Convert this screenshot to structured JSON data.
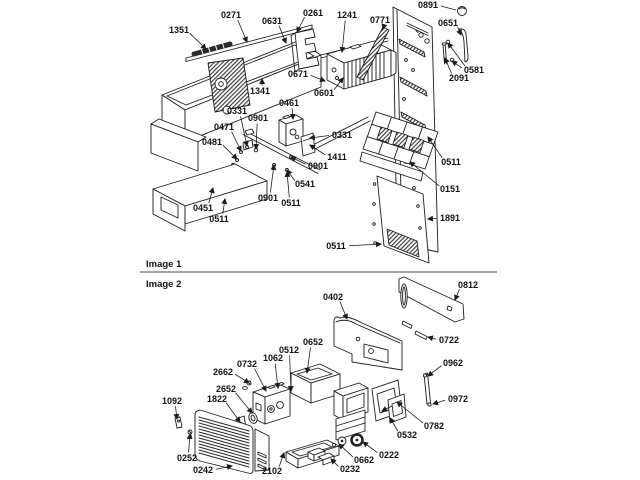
{
  "page": {
    "background": "#ffffff",
    "line_color": "#1c1c1c",
    "label_color": "#111111",
    "type": "exploded-parts-diagram"
  },
  "image1": {
    "title": "Image 1",
    "labels": [
      {
        "text": "0271",
        "x": 231,
        "y": 15,
        "tx": 247,
        "ty": 42
      },
      {
        "text": "0631",
        "x": 272,
        "y": 21,
        "tx": 286,
        "ty": 43
      },
      {
        "text": "1351",
        "x": 179,
        "y": 30,
        "tx": 206,
        "ty": 49
      },
      {
        "text": "0261",
        "x": 313,
        "y": 13,
        "tx": 297,
        "ty": 32
      },
      {
        "text": "1241",
        "x": 347,
        "y": 15,
        "tx": 342,
        "ty": 52
      },
      {
        "text": "0771",
        "x": 380,
        "y": 20,
        "tx": 383,
        "ty": 29
      },
      {
        "text": "0891",
        "x": 428,
        "y": 5,
        "tx": 456,
        "ty": 10,
        "na": 1
      },
      {
        "text": "0651",
        "x": 448,
        "y": 23,
        "tx": 461,
        "ty": 35
      },
      {
        "text": "0581",
        "x": 474,
        "y": 70,
        "tx": 448,
        "ty": 43,
        "tx2": 452,
        "ty2": 61
      },
      {
        "text": "2091",
        "x": 459,
        "y": 78,
        "tx": 445,
        "ty": 58
      },
      {
        "text": "0671",
        "x": 298,
        "y": 74,
        "tx": 325,
        "ty": 81
      },
      {
        "text": "0601",
        "x": 324,
        "y": 93,
        "tx": 343,
        "ty": 78
      },
      {
        "text": "1341",
        "x": 260,
        "y": 91,
        "tx": 262,
        "ty": 79
      },
      {
        "text": "0461",
        "x": 289,
        "y": 103,
        "tx": 293,
        "ty": 119
      },
      {
        "text": "0331",
        "x": 237,
        "y": 111,
        "tx": 247,
        "ty": 146
      },
      {
        "text": "0901",
        "x": 258,
        "y": 118,
        "tx": 256,
        "ty": 149
      },
      {
        "text": "0471",
        "x": 224,
        "y": 127,
        "tx": 241,
        "ty": 151
      },
      {
        "text": "0481",
        "x": 212,
        "y": 142,
        "tx": 237,
        "ty": 159
      },
      {
        "text": "0331",
        "x": 342,
        "y": 135,
        "tx": 310,
        "ty": 138
      },
      {
        "text": "1411",
        "x": 337,
        "y": 157,
        "tx": 310,
        "ty": 145
      },
      {
        "text": "0901",
        "x": 318,
        "y": 166,
        "tx": 291,
        "ty": 157
      },
      {
        "text": "0541",
        "x": 305,
        "y": 184,
        "tx": 287,
        "ty": 170
      },
      {
        "text": "0901",
        "x": 268,
        "y": 198,
        "tx": 274,
        "ty": 165
      },
      {
        "text": "0511",
        "x": 291,
        "y": 203,
        "tx": 287,
        "ty": 172
      },
      {
        "text": "0451",
        "x": 203,
        "y": 208,
        "tx": 213,
        "ty": 188
      },
      {
        "text": "0511",
        "x": 219,
        "y": 219,
        "tx": 225,
        "ty": 199
      },
      {
        "text": "0511",
        "x": 451,
        "y": 162,
        "tx": 428,
        "ty": 137
      },
      {
        "text": "0151",
        "x": 450,
        "y": 189,
        "tx": 410,
        "ty": 162
      },
      {
        "text": "1891",
        "x": 450,
        "y": 218,
        "tx": 428,
        "ty": 219
      },
      {
        "text": "0511",
        "x": 336,
        "y": 246,
        "tx": 381,
        "ty": 244
      }
    ]
  },
  "image2": {
    "title": "Image 2",
    "labels": [
      {
        "text": "0402",
        "x": 333,
        "y": 297,
        "tx": 347,
        "ty": 319
      },
      {
        "text": "0812",
        "x": 468,
        "y": 285,
        "tx": 455,
        "ty": 300
      },
      {
        "text": "0722",
        "x": 449,
        "y": 340,
        "tx": 428,
        "ty": 337
      },
      {
        "text": "0962",
        "x": 453,
        "y": 363,
        "tx": 428,
        "ty": 376
      },
      {
        "text": "0972",
        "x": 458,
        "y": 399,
        "tx": 433,
        "ty": 404
      },
      {
        "text": "0652",
        "x": 313,
        "y": 342,
        "tx": 307,
        "ty": 373
      },
      {
        "text": "0512",
        "x": 289,
        "y": 350,
        "tx": 291,
        "ty": 391
      },
      {
        "text": "1062",
        "x": 273,
        "y": 358,
        "tx": 278,
        "ty": 388
      },
      {
        "text": "0732",
        "x": 247,
        "y": 364,
        "tx": 266,
        "ty": 391
      },
      {
        "text": "2662",
        "x": 223,
        "y": 372,
        "tx": 249,
        "ty": 383
      },
      {
        "text": "2652",
        "x": 226,
        "y": 389,
        "tx": 252,
        "ty": 413
      },
      {
        "text": "1822",
        "x": 217,
        "y": 399,
        "tx": 240,
        "ty": 422
      },
      {
        "text": "1092",
        "x": 172,
        "y": 401,
        "tx": 177,
        "ty": 419
      },
      {
        "text": "0252",
        "x": 187,
        "y": 458,
        "tx": 190,
        "ty": 434
      },
      {
        "text": "0242",
        "x": 203,
        "y": 470,
        "tx": 232,
        "ty": 466
      },
      {
        "text": "2102",
        "x": 272,
        "y": 471,
        "tx": 284,
        "ty": 453
      },
      {
        "text": "0232",
        "x": 350,
        "y": 469,
        "tx": 331,
        "ty": 459
      },
      {
        "text": "0662",
        "x": 364,
        "y": 460,
        "tx": 339,
        "ty": 444
      },
      {
        "text": "0222",
        "x": 389,
        "y": 455,
        "tx": 363,
        "ty": 442
      },
      {
        "text": "0532",
        "x": 407,
        "y": 435,
        "tx": 390,
        "ty": 418
      },
      {
        "text": "0782",
        "x": 434,
        "y": 426,
        "tx": 397,
        "ty": 402
      }
    ]
  }
}
